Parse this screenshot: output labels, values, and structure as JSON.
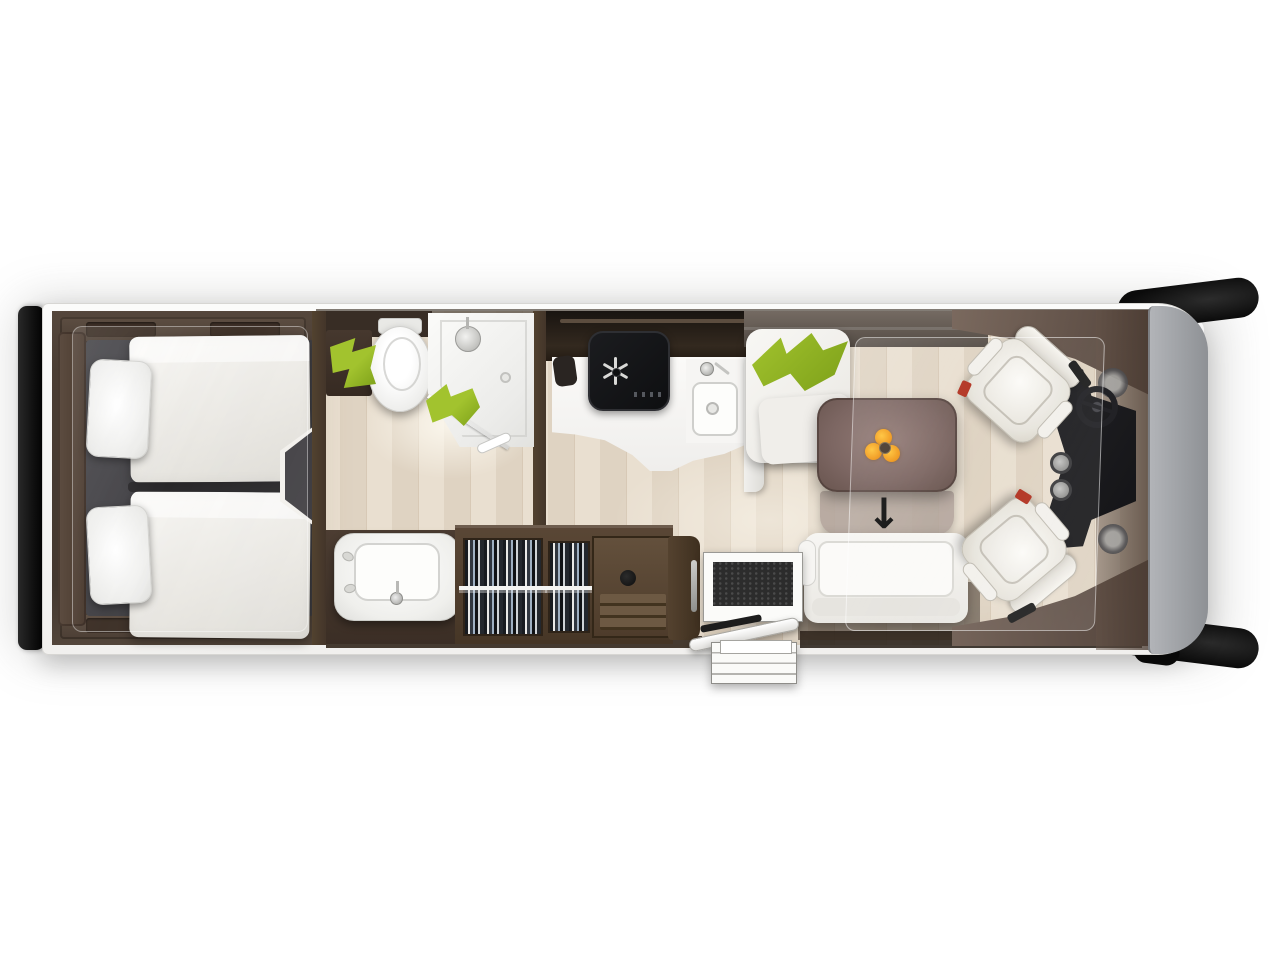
{
  "scene": {
    "description": "Top-down motorhome floor plan rendering, rear at left and driver cab at right",
    "zones": [
      "twin-bedroom",
      "bathroom",
      "wardrobe",
      "kitchen",
      "dinette-lounge",
      "driver-cab"
    ]
  },
  "glyphs": {
    "entry_arrow": "↓"
  },
  "colors": {
    "page_bg": "#ffffff",
    "floor_a": "#e9dfd0",
    "floor_b": "#dfd3c2",
    "green": "#a2c32e",
    "green_dark": "#7da019",
    "flower_orange": "#f29a18",
    "arrow_black": "#101010"
  },
  "fixtures": [
    "rear-bumper",
    "side-mirror-top",
    "side-mirror-bottom",
    "single-bed-top",
    "single-bed-bottom",
    "pillow-top",
    "pillow-bottom",
    "bedroom-doorway",
    "toilet",
    "shower-enclosure",
    "shower-head",
    "green-towel-a",
    "green-towel-b",
    "washbasin",
    "wardrobe-hanging-clothes",
    "drawer-unit",
    "kitchen-counter",
    "cooktop",
    "kitchen-sink",
    "dinette-bench",
    "green-cushions",
    "dining-table",
    "flower-vase",
    "sofa",
    "doormat",
    "entry-door",
    "entry-steps",
    "swivel-seat-top",
    "swivel-seat-bottom",
    "dashboard-console",
    "steering-wheel",
    "cupholders",
    "front-cap"
  ]
}
